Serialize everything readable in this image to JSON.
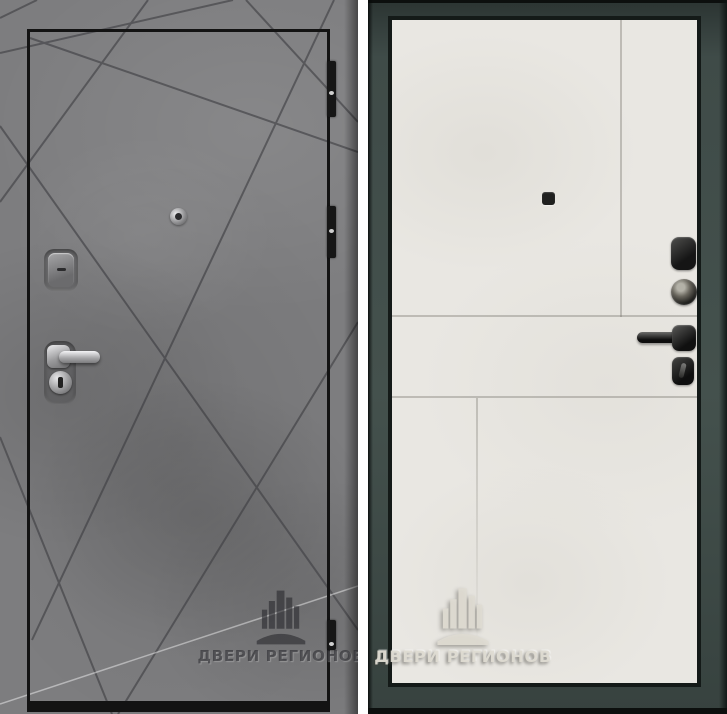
{
  "brand": {
    "watermark_text": "ДВЕРИ РЕГИОНОВ",
    "logo_icon": "buildings-arch-logo"
  },
  "left_door": {
    "watermark_text": "ДВЕРИ РЕГИОНОВ",
    "hardware_icons": [
      "door-hinge",
      "door-hinge",
      "door-hinge",
      "peephole",
      "keyhole-cover",
      "lever-handle",
      "lock-cylinder"
    ]
  },
  "right_door": {
    "watermark_text": "ДВЕРИ РЕГИОНОВ",
    "hardware_icons": [
      "peephole",
      "night-latch",
      "lock-cylinder",
      "lever-handle",
      "thumb-turn"
    ]
  },
  "colors": {
    "concrete_gray": "#7d7d7f",
    "concrete_groove": "#46464a",
    "leaf_outline_black": "#131313",
    "chrome": "#c9c9cb",
    "frame_slate": "#44514d",
    "frame_black": "#141a18",
    "panel_white": "#e9e7e2",
    "hardware_black": "#1b1b1b",
    "watermark_dark": "#2a2a2e",
    "watermark_light": "#dedbd2"
  }
}
